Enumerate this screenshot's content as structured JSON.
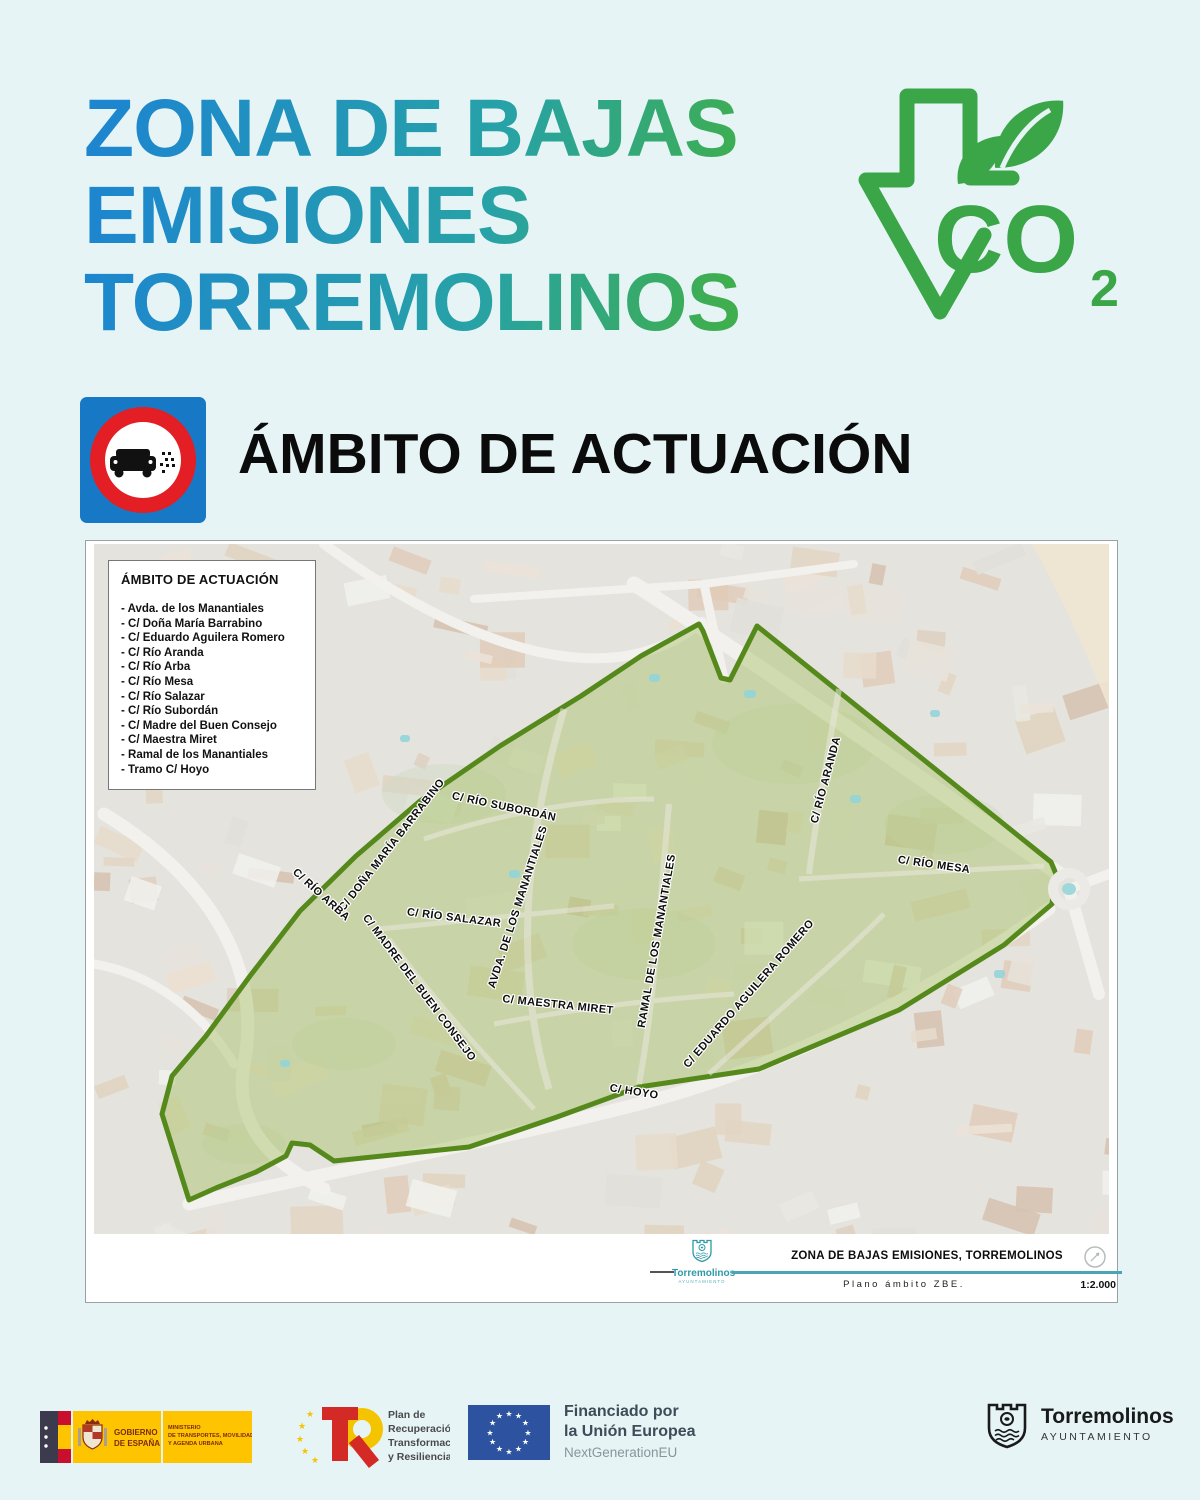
{
  "header": {
    "title_lines": [
      "ZONA DE BAJAS",
      "EMISIONES",
      "TORREMOLINOS"
    ],
    "co2_text": "CO",
    "co2_sub": "2"
  },
  "section": {
    "heading": "ÁMBITO DE ACTUACIÓN"
  },
  "map": {
    "legend": {
      "title": "ÁMBITO DE ACTUACIÓN",
      "streets": [
        "- Avda. de los Manantiales",
        "- C/ Doña María Barrabino",
        "- C/ Eduardo Aguilera Romero",
        "- C/ Río Aranda",
        "- C/ Río Arba",
        "- C/ Río Mesa",
        "- C/ Río Salazar",
        "- C/ Río Subordán",
        "- C/ Madre del Buen Consejo",
        "- C/ Maestra Miret",
        "- Ramal de los Manantiales",
        "- Tramo C/ Hoyo"
      ]
    },
    "labels": [
      {
        "text": "C/ RÍO SUBORDÁN",
        "x": 410,
        "y": 263,
        "rot": 12
      },
      {
        "text": "C/ DOÑA MARÍA BARRABINO",
        "x": 298,
        "y": 301,
        "rot": -52
      },
      {
        "text": "C/ RÍO ARBA",
        "x": 227,
        "y": 351,
        "rot": 42
      },
      {
        "text": "C/ RÍO SALAZAR",
        "x": 360,
        "y": 374,
        "rot": 7
      },
      {
        "text": "AVDA. DE LOS MANANTIALES",
        "x": 424,
        "y": 363,
        "rot": -72
      },
      {
        "text": "C/ MADRE DEL BUEN CONSEJO",
        "x": 325,
        "y": 444,
        "rot": 53
      },
      {
        "text": "C/ MAESTRA MIRET",
        "x": 464,
        "y": 461,
        "rot": 6
      },
      {
        "text": "RAMAL DE LOS MANANTIALES",
        "x": 563,
        "y": 397,
        "rot": -80
      },
      {
        "text": "C/ EDUARDO AGUILERA ROMERO",
        "x": 655,
        "y": 450,
        "rot": -49
      },
      {
        "text": "C/ RÍO ARANDA",
        "x": 732,
        "y": 236,
        "rot": -75
      },
      {
        "text": "C/ RÍO MESA",
        "x": 840,
        "y": 321,
        "rot": 8
      },
      {
        "text": "C/ HOYO",
        "x": 540,
        "y": 548,
        "rot": 9
      }
    ],
    "titleblock": {
      "logo_name": "Torremolinos",
      "logo_sub": "AYUNTAMIENTO",
      "title": "ZONA DE BAJAS EMISIONES, TORREMOLINOS",
      "subtitle": "Plano ámbito ZBE.",
      "scale": "1:2.000"
    }
  },
  "footer": {
    "gobierno": {
      "name_lines": [
        "GOBIERNO",
        "DE ESPAÑA"
      ],
      "ministry_lines": [
        "MINISTERIO",
        "DE TRANSPORTES, MOVILIDAD",
        "Y AGENDA URBANA"
      ]
    },
    "prtr": {
      "lines": [
        "Plan de",
        "Recuperación,",
        "Transformación",
        "y Resiliencia"
      ]
    },
    "eu": {
      "line1": "Financiado por",
      "line2": "la Unión Europea",
      "line3": "NextGenerationEU"
    },
    "torremolinos": {
      "name": "Torremolinos",
      "sub": "AYUNTAMIENTO"
    }
  },
  "colors": {
    "page_bg": "#e6f4f6",
    "title_blue": "#1d86cf",
    "title_green": "#3fae4e",
    "co2_green": "#3aa648",
    "sign_blue": "#1779c6",
    "sign_red": "#e31e24",
    "zone_fill": "#a9c56b",
    "zone_stroke": "#56891b",
    "teal_line": "#4aa6b5"
  }
}
